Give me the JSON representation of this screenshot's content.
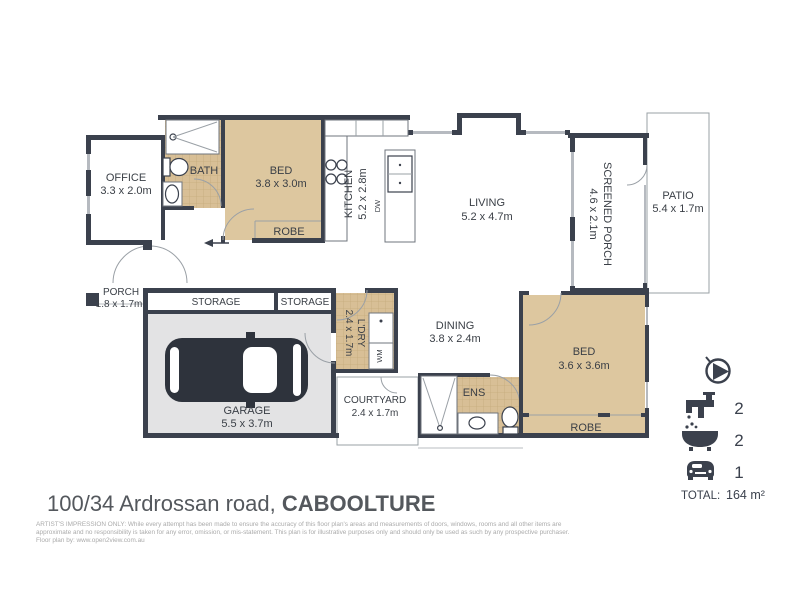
{
  "plan": {
    "rooms": {
      "office": {
        "name": "OFFICE",
        "dims": "3.3 x 2.0m"
      },
      "bath": {
        "name": "BATH"
      },
      "bed1": {
        "name": "BED",
        "dims": "3.8 x 3.0m"
      },
      "robe1": {
        "name": "ROBE"
      },
      "kitchen": {
        "name": "KITCHEN",
        "dims": "5.2 x 2.8m"
      },
      "living": {
        "name": "LIVING",
        "dims": "5.2 x 4.7m"
      },
      "screened_porch": {
        "name": "SCREENED PORCH",
        "dims": "4.6 x 2.1m"
      },
      "patio": {
        "name": "PATIO",
        "dims": "5.4 x 1.7m"
      },
      "porch": {
        "name": "PORCH",
        "dims": "1.8 x 1.7m"
      },
      "storage1": {
        "name": "STORAGE"
      },
      "storage2": {
        "name": "STORAGE"
      },
      "garage": {
        "name": "GARAGE",
        "dims": "5.5 x 3.7m"
      },
      "laundry": {
        "name": "L'DRY",
        "dims": "2.4 x 1.7m"
      },
      "dining": {
        "name": "DINING",
        "dims": "3.8 x 2.4m"
      },
      "courtyard": {
        "name": "COURTYARD",
        "dims": "2.4 x 1.7m"
      },
      "ens": {
        "name": "ENS"
      },
      "bed2": {
        "name": "BED",
        "dims": "3.6 x 3.6m"
      },
      "robe2": {
        "name": "ROBE"
      }
    },
    "appliances": {
      "dishwasher": "DW",
      "washing_machine": "WM"
    }
  },
  "legend": {
    "taps_count": "2",
    "baths_count": "2",
    "cars_count": "1",
    "total_label": "TOTAL:",
    "total_value": "164 m²"
  },
  "footer": {
    "address_street": "100/34 Ardrossan road, ",
    "address_suburb": "CABOOLTURE",
    "disclaimer_line1": "ARTIST'S IMPRESSION ONLY: While every attempt has been made to ensure the accuracy of this floor plan's areas and measurements of doors, windows, rooms and all other items are",
    "disclaimer_line2": "approximate and no responsibility is taken for any error, omission, or mis-statement. This plan is for illustrative purposes only and should only be used as such by any prospective purchaser.",
    "disclaimer_line3": "Floor plan by: www.open2view.com.au"
  },
  "colors": {
    "wall": "#3b414d",
    "room_fill": "#ddc79f",
    "tile_fill": "#d8bf96",
    "garage_floor": "#e3e3e4",
    "outline": "#9aa0a6",
    "label_text": "#3a3f46",
    "title_text": "#54585d",
    "disclaimer_text": "#ababab"
  }
}
